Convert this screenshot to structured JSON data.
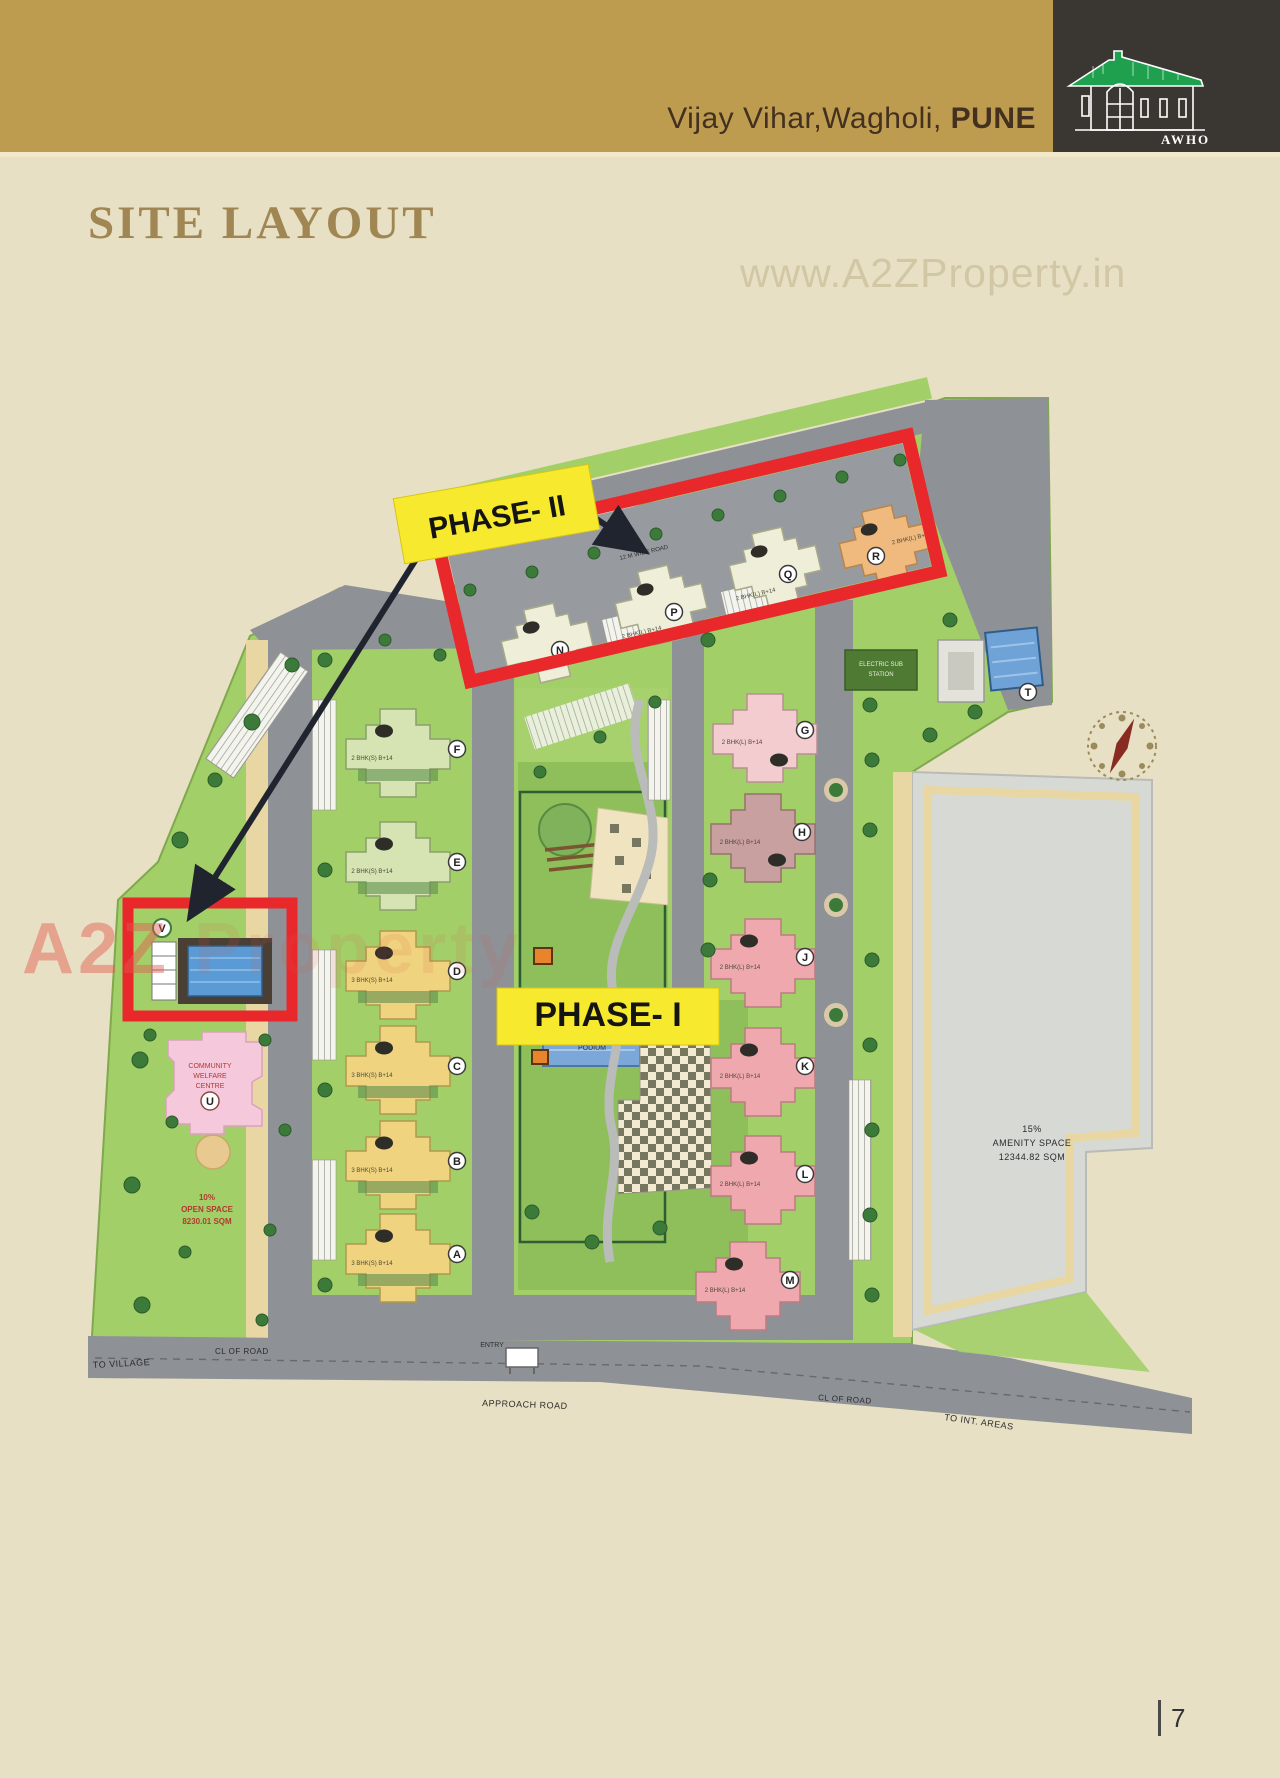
{
  "header": {
    "location_prefix": "Vijay Vihar,Wagholi, ",
    "city": "PUNE",
    "org": "AWHO"
  },
  "page": {
    "title": "SITE LAYOUT",
    "number": "7"
  },
  "watermarks": {
    "top": "www.A2ZProperty.in",
    "left_strong": "A2Z",
    "left_faint": " Property"
  },
  "labels": {
    "phase1": "PHASE- I",
    "phase2": "PHASE- II",
    "podium": "PODIUM",
    "open_space_l1": "10%",
    "open_space_l2": "OPEN SPACE",
    "open_space_l3": "8230.01 SQM",
    "amenity_l1": "15%",
    "amenity_l2": "AMENITY SPACE",
    "amenity_l3": "12344.82 SQM",
    "community_l1": "COMMUNITY",
    "community_l2": "WELFARE",
    "community_l3": "CENTRE",
    "electric_l1": "ELECTRIC SUB",
    "electric_l2": "STATION",
    "to_village": "TO VILLAGE",
    "cl_of_road_left": "CL OF ROAD",
    "approach_road": "APPROACH ROAD",
    "cl_of_road_right": "CL OF ROAD",
    "to_int_areas": "TO INT. AREAS",
    "entry": "ENTRY",
    "wide_road": "12 M WIDE ROAD"
  },
  "colors": {
    "banner_gold": "#BD9C50",
    "accent_red": "#E8282B",
    "label_yellow": "#F7E92E",
    "logo_green": "#1FA04F"
  },
  "buildings": [
    {
      "letter": "A",
      "units": "3 BHK(S) B+14"
    },
    {
      "letter": "B",
      "units": "3 BHK(S) B+14"
    },
    {
      "letter": "C",
      "units": "3 BHK(S) B+14"
    },
    {
      "letter": "D",
      "units": "3 BHK(S) B+14"
    },
    {
      "letter": "E",
      "units": "2 BHK(S) B+14"
    },
    {
      "letter": "F",
      "units": "2 BHK(S) B+14"
    },
    {
      "letter": "G",
      "units": "2 BHK(L) B+14"
    },
    {
      "letter": "H",
      "units": "2 BHK(L) B+14"
    },
    {
      "letter": "J",
      "units": "2 BHK(L) B+14"
    },
    {
      "letter": "K",
      "units": "2 BHK(L) B+14"
    },
    {
      "letter": "L",
      "units": "2 BHK(L) B+14"
    },
    {
      "letter": "M",
      "units": "2 BHK(L) B+14"
    },
    {
      "letter": "N",
      "units": "2 BHK(L) B+14"
    },
    {
      "letter": "P",
      "units": "2 BHK(L) B+14"
    },
    {
      "letter": "Q",
      "units": "2 BHK(L) B+14"
    },
    {
      "letter": "R",
      "units": "2 BHK(L) B+14"
    },
    {
      "letter": "T",
      "units": ""
    },
    {
      "letter": "U",
      "units": ""
    },
    {
      "letter": "V",
      "units": ""
    }
  ]
}
